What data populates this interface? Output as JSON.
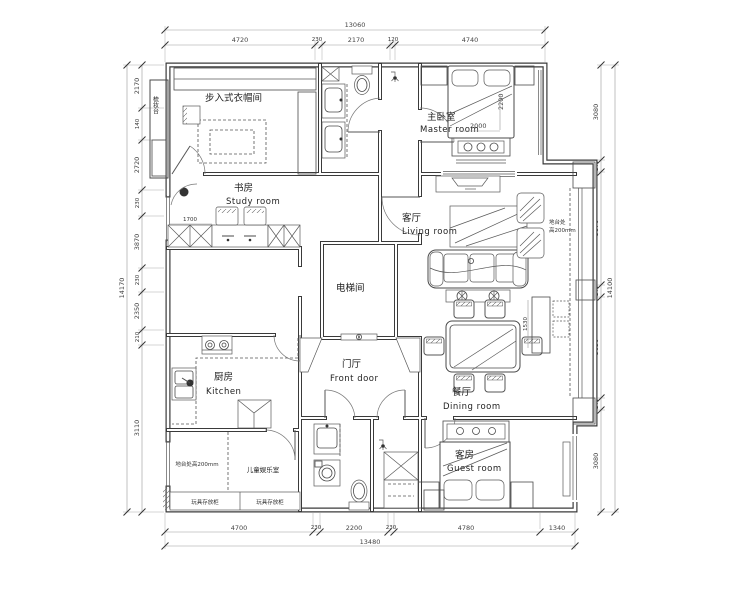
{
  "colors": {
    "ink": "#3a3a3a",
    "dim_text": "#444444",
    "background": "#ffffff"
  },
  "rooms": {
    "closet": {
      "zh": "步入式衣帽间"
    },
    "study": {
      "zh": "书房",
      "en": "Study room"
    },
    "master": {
      "zh": "主卧室",
      "en": "Master room"
    },
    "living": {
      "zh": "客厅",
      "en": "Living room"
    },
    "elevator": {
      "zh": "电梯间"
    },
    "kitchen": {
      "zh": "厨房",
      "en": "Kitchen"
    },
    "hall": {
      "zh": "门厅",
      "en": "Front door"
    },
    "dining": {
      "zh": "餐厅",
      "en": "Dining room"
    },
    "guest": {
      "zh": "客房",
      "en": "Guest room"
    },
    "kids": {
      "zh": "儿童娱乐室"
    }
  },
  "annotations": {
    "bay_l1": "地台处",
    "bay_l2": "高200mm",
    "platform": "地台处高200mm",
    "toys1": "玩具存放柜",
    "toys2": "玩具存放柜",
    "dresser": "梳妆台",
    "bed_w": "2000",
    "bed_d": "2200",
    "desk_w": "1700",
    "sideboard": "1530"
  },
  "dimensions": {
    "top": {
      "total": "13060",
      "segments": [
        "4720",
        "230",
        "2170",
        "120",
        "4740"
      ]
    },
    "bottom": {
      "total": "13480",
      "segments": [
        "4700",
        "230",
        "2200",
        "230",
        "4780",
        "1340"
      ]
    },
    "left": {
      "total": "14170",
      "segments": [
        "2170",
        "140",
        "2720",
        "230",
        "3870",
        "230",
        "2350",
        "210",
        "3110"
      ]
    },
    "right": {
      "total": "14100",
      "segments": [
        "3080",
        "140",
        "3870",
        "140",
        "3630",
        "140",
        "3080"
      ]
    }
  }
}
